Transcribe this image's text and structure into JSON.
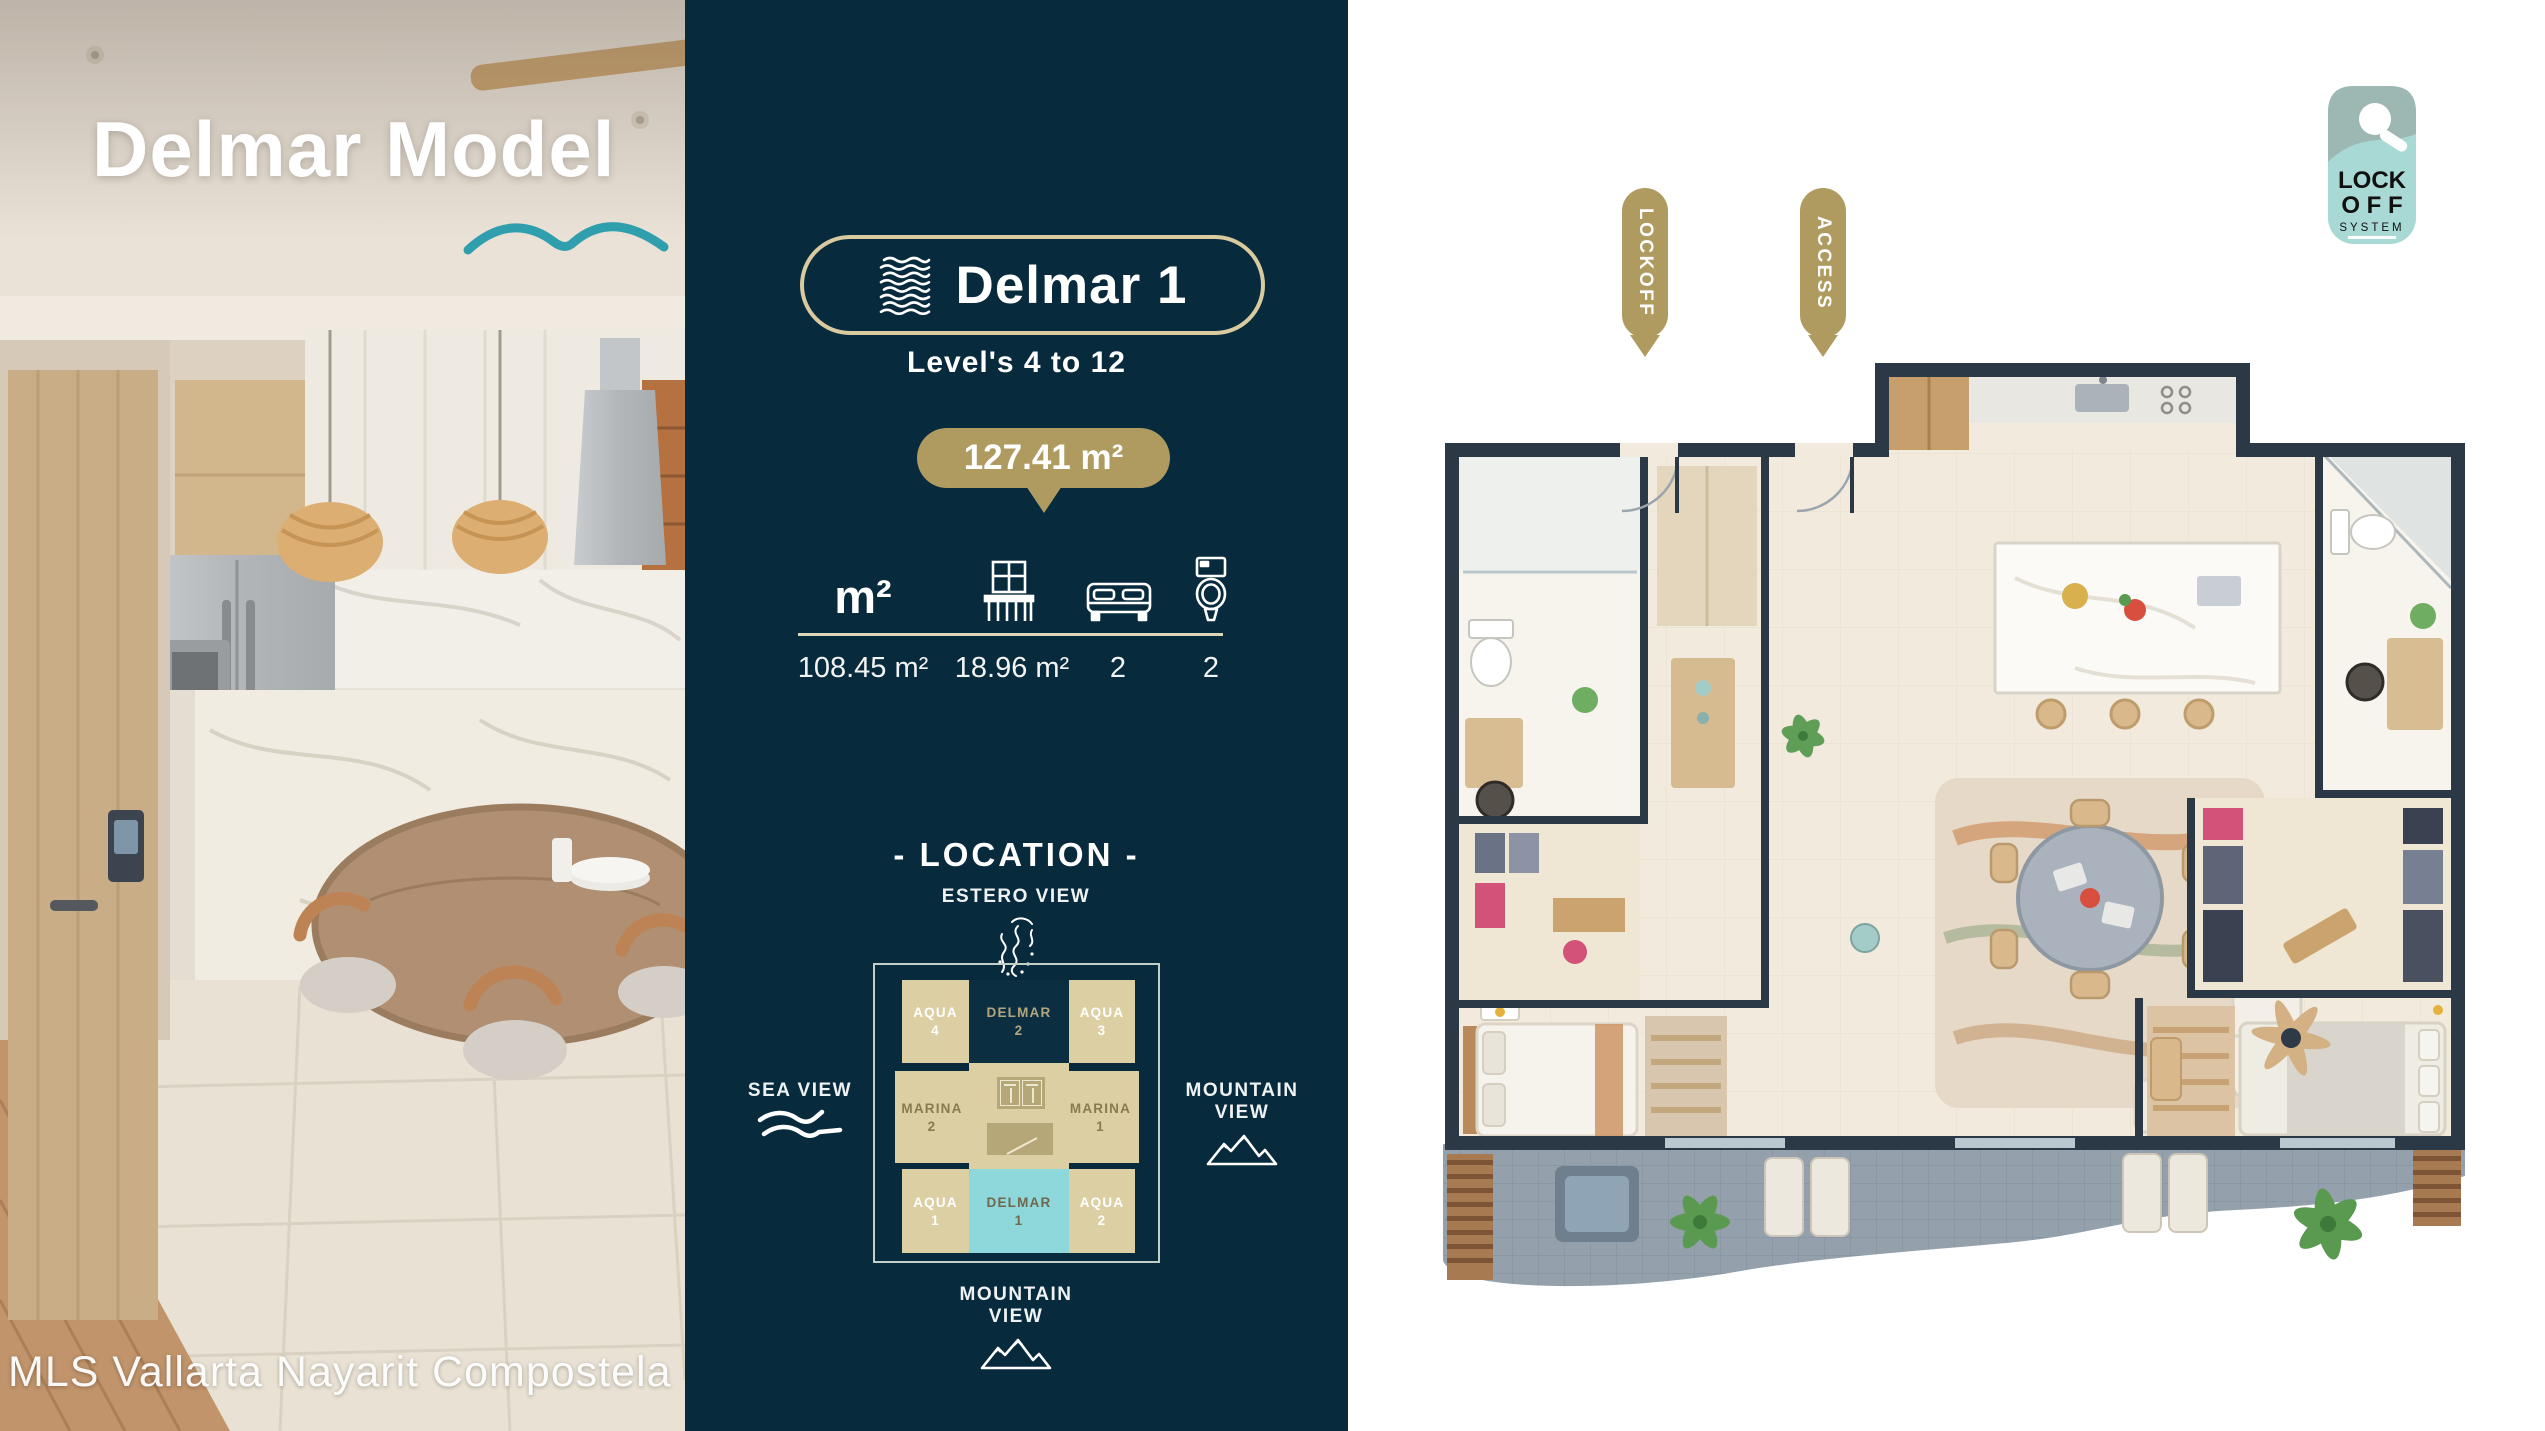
{
  "colors": {
    "navy": "#082a3d",
    "gold": "#af9b60",
    "pill_border_tan": "#d9caa0",
    "grid_cell_tan": "#dccfa3",
    "grid_cell_cyan": "#8ed8db",
    "wave_teal": "#2f9fae"
  },
  "photo": {
    "title": "Delmar Model",
    "watermark": "MLS Vallarta Nayarit Compostela"
  },
  "panel": {
    "unit_badge": {
      "label": "Delmar 1"
    },
    "levels": "Level's 4 to 12",
    "total_area": "127.41 m²",
    "specs": {
      "interior_label": "m²",
      "interior_value": "108.45 m²",
      "balcony_value": "18.96 m²",
      "bedrooms_value": "2",
      "bathrooms_value": "2"
    },
    "location": {
      "title": "- LOCATION -",
      "top_view": "ESTERO VIEW",
      "left_view": "SEA VIEW",
      "right_view": "MOUNTAIN VIEW",
      "bottom_view": "MOUNTAIN VIEW",
      "grid": {
        "cells": [
          {
            "line1": "AQUA",
            "line2": "4"
          },
          {
            "line1": "DELMAR",
            "line2": "2"
          },
          {
            "line1": "AQUA",
            "line2": "3"
          },
          {
            "line1": "MARINA",
            "line2": "2"
          },
          {
            "line1": "MARINA",
            "line2": "1"
          },
          {
            "line1": "AQUA",
            "line2": "1"
          },
          {
            "line1": "DELMAR",
            "line2": "1"
          },
          {
            "line1": "AQUA",
            "line2": "2"
          }
        ]
      }
    }
  },
  "plan": {
    "lockoff_tag": "LOCKOFF",
    "access_tag": "ACCESS",
    "hanger": {
      "line1": "LOCK",
      "line2": "O F F",
      "line3": "SYSTEM"
    }
  }
}
